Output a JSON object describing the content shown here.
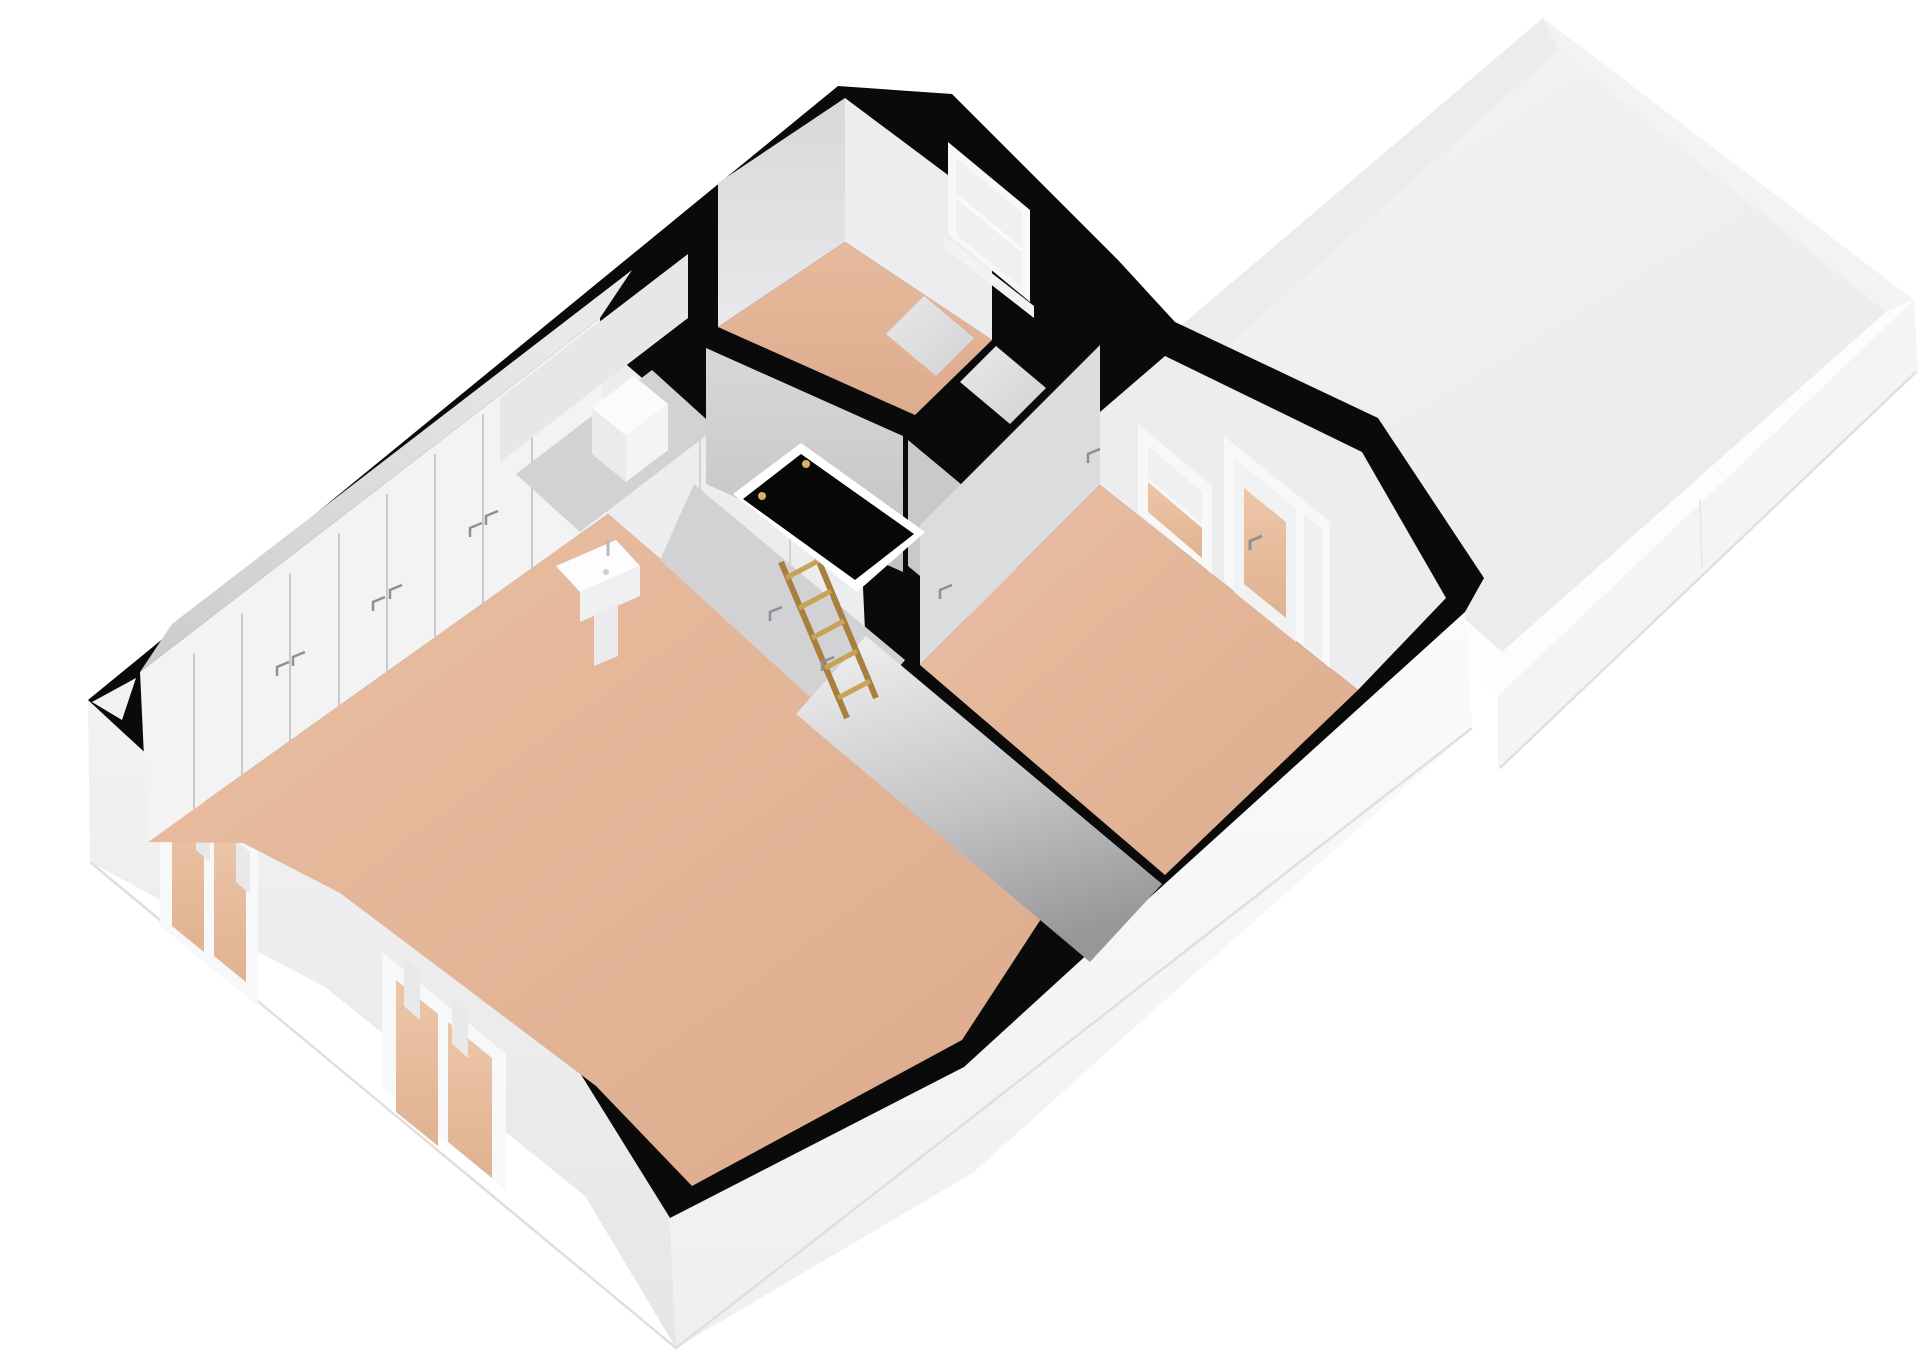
{
  "scene": {
    "kind": "3d-floorplan-render",
    "inventory": [
      {
        "name": "roof-terrace",
        "desc": "flat roof terrace tray with low parapet walls"
      },
      {
        "name": "large-room",
        "desc": "large attic room with closet wall, wash basin and two exterior windows"
      },
      {
        "name": "top-room",
        "desc": "small upper room with one window"
      },
      {
        "name": "right-room",
        "desc": "room with window and glazed door to terrace"
      },
      {
        "name": "hallway",
        "desc": "landing with loft hatch and wooden loft ladder"
      },
      {
        "name": "storage-cells",
        "desc": "two small storage compartments between rooms"
      }
    ]
  },
  "palette": {
    "background": "#ffffff",
    "wall_cut_black": "#0a0a0a",
    "floor_tan": "#e2b295",
    "hall_floor": "#d2d2d4",
    "cell_floor": "#e2e2e4",
    "wall_light": "#ededef",
    "wall_mid": "#dcdcde",
    "wall_back": "#c9c9cb",
    "terrace_floor": "#f0f0f1",
    "terrace_wall_inner_left": "#ececee",
    "terrace_wall_inner_top": "#f3f3f5",
    "terrace_wall_white": "#fdfdfe",
    "terrace_slab": "#f4f4f5",
    "exterior_left": "#ededee",
    "exterior_right": "#f8f8f9",
    "glass_light": "#eef0f2",
    "glass_tan": "#e5bc9e",
    "frame_white": "#f8f8f9",
    "chimney_white": "#fbfbfc",
    "ladder_wood": "#c9a259",
    "ladder_wood_dark": "#a97f3f",
    "hatch_black": "#070707",
    "hatch_border": "#ffffff",
    "hinge_gold": "#d8b35a",
    "handle_gray": "#8f8f95",
    "seam_gray": "#c9c9cc",
    "shadow_line": "#dfdfe0"
  }
}
